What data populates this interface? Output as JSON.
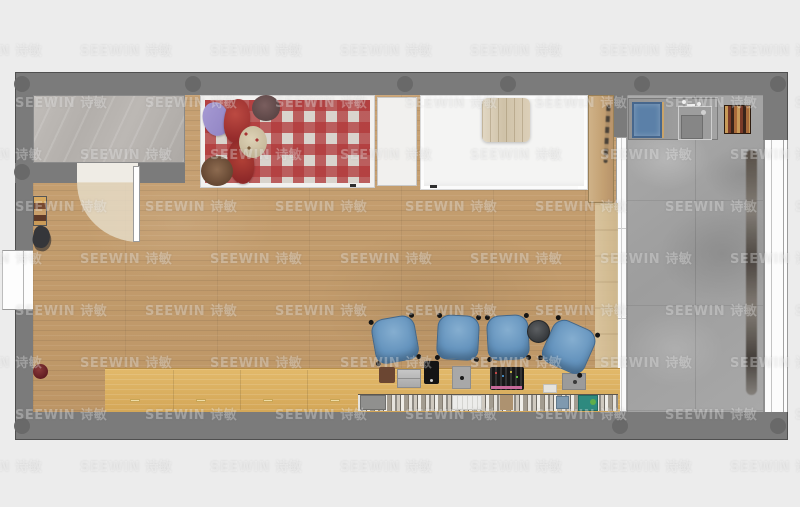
{
  "watermark": {
    "text": "SEEWIN 诗敏",
    "color": "rgba(255,255,255,0.30)",
    "grid": {
      "rows": 9,
      "cols": 7,
      "start_x": -50,
      "start_y": 40,
      "col_step": 130,
      "row_step": 52,
      "odd_row_offset": 65
    }
  },
  "palette": {
    "bg": "#ececec",
    "wall": "#7b7b7b",
    "wall_dark": "#696969",
    "tile": "#b8b4b0",
    "wood_floor": "#c7a173",
    "desk_wood": "#e2b96a",
    "concrete": "#9d9d9d",
    "chair_blue": "#6493bd",
    "blanket_red": "#b13738",
    "bed_white": "#f4f4f3",
    "mat_blue": "#5b80a8",
    "teal": "#2e8a7f",
    "pot_red": "#5e1a20",
    "door_beige": "#e5dbc6"
  },
  "scene": {
    "type": "apartment-floor-plan-top-view",
    "rooms": [
      {
        "name": "entry-alcove",
        "floor": "gray-marble-tile"
      },
      {
        "name": "main-studio-room",
        "floor": "wood-plank"
      },
      {
        "name": "bathroom",
        "floor": "gray-concrete-tile"
      }
    ],
    "furniture": [
      "entry-door-with-swing-arc",
      "shoe-rack",
      "gear-pile",
      "red-plant-pot",
      "checkered-bed-with-pillows",
      "white-closet-panel",
      "white-bed-with-quilt",
      "wood-wardrobe",
      "tall-side-cabinet",
      "sliding-door",
      "vanity-counter",
      "blue-bath-mat",
      "sink-with-faucet",
      "bottle-shelf",
      "hanging-towels",
      "study-counter",
      "under-counter-bookshelf",
      "blue-chairs",
      "round-stool",
      "desk-mat",
      "laptop",
      "tablet",
      "note-pad",
      "keyboard",
      "paper-sheet",
      "mouse-pad",
      "left-window",
      "right-window",
      "wall-columns"
    ],
    "chair_count": 4
  }
}
